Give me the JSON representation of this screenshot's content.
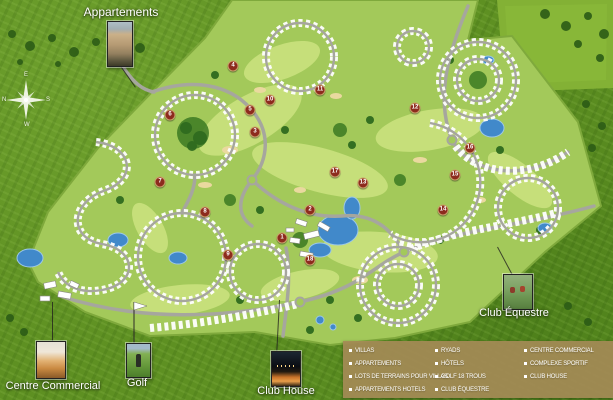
{
  "map": {
    "labels": {
      "appartements": "Appartements",
      "centre_commercial": "Centre Commercial",
      "golf": "Golf",
      "club_house": "Club House",
      "club_equestre": "Club Équestre"
    },
    "compass": {
      "top": "E",
      "right": "S",
      "bottom": "W",
      "left": "N"
    },
    "hole_markers": [
      {
        "n": 1,
        "x": 282,
        "y": 238
      },
      {
        "n": 2,
        "x": 310,
        "y": 210
      },
      {
        "n": 3,
        "x": 255,
        "y": 132
      },
      {
        "n": 4,
        "x": 233,
        "y": 66
      },
      {
        "n": 5,
        "x": 250,
        "y": 110
      },
      {
        "n": 6,
        "x": 170,
        "y": 115
      },
      {
        "n": 7,
        "x": 160,
        "y": 182
      },
      {
        "n": 8,
        "x": 205,
        "y": 212
      },
      {
        "n": 9,
        "x": 228,
        "y": 255
      },
      {
        "n": 10,
        "x": 270,
        "y": 100
      },
      {
        "n": 11,
        "x": 320,
        "y": 90
      },
      {
        "n": 12,
        "x": 415,
        "y": 108
      },
      {
        "n": 13,
        "x": 363,
        "y": 183
      },
      {
        "n": 14,
        "x": 443,
        "y": 210
      },
      {
        "n": 15,
        "x": 455,
        "y": 175
      },
      {
        "n": 16,
        "x": 470,
        "y": 148
      },
      {
        "n": 17,
        "x": 335,
        "y": 172
      },
      {
        "n": 18,
        "x": 310,
        "y": 260
      }
    ],
    "colors": {
      "outer_grass": "#5e9022",
      "development_green": "#a3c95a",
      "fairway_green": "#c8e17c",
      "tree_green": "#2f6b1f",
      "water_blue": "#4189ca",
      "sand_tan": "#ead99f",
      "road_grey": "#a6a69e",
      "hole_marker_red": "#8d2b1e",
      "legend_tan": "#a48a56",
      "label_white": "#ffffff"
    }
  },
  "legend": {
    "columns": [
      {
        "items": [
          "VILLAS",
          "APPARTEMENTS",
          "LOTS DE TERRAINS POUR VILLAS",
          "APPARTEMENTS HOTELS"
        ]
      },
      {
        "items": [
          "RYADS",
          "HÔTELS",
          "GOLF 18 TROUS",
          "CLUB ÉQUESTRE"
        ]
      },
      {
        "items": [
          "CENTRE COMMERCIAL",
          "COMPLEXE SPORTIF",
          "CLUB HOUSE"
        ]
      }
    ]
  }
}
